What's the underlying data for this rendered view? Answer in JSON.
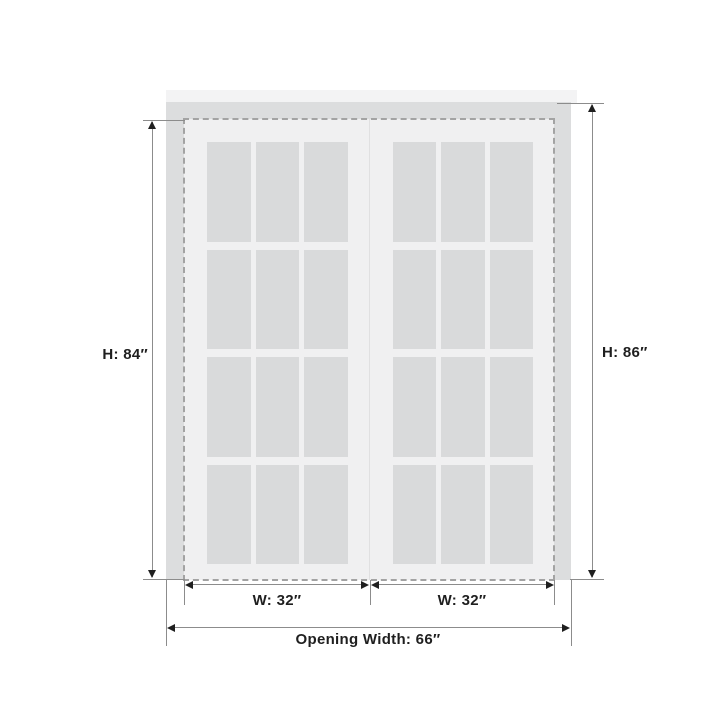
{
  "diagram": {
    "kind": "double-door-dimension-drawing",
    "labels": {
      "door_height": "H: 84″",
      "opening_height": "H: 86″",
      "left_door_width": "W: 32″",
      "right_door_width": "W: 32″",
      "opening_width": "Opening Width: 66″"
    },
    "doors": {
      "count": 2,
      "lite_columns": 3,
      "lite_rows": 4
    },
    "colors": {
      "background": "#ffffff",
      "header_strip": "#f3f3f4",
      "frame": "#dcddde",
      "door": "#f0f0f1",
      "glass": "#d9dadb",
      "dashed_outline": "#a3a3a3",
      "dimension_line": "#8c8c8c",
      "ink": "#1f1f1f"
    }
  }
}
